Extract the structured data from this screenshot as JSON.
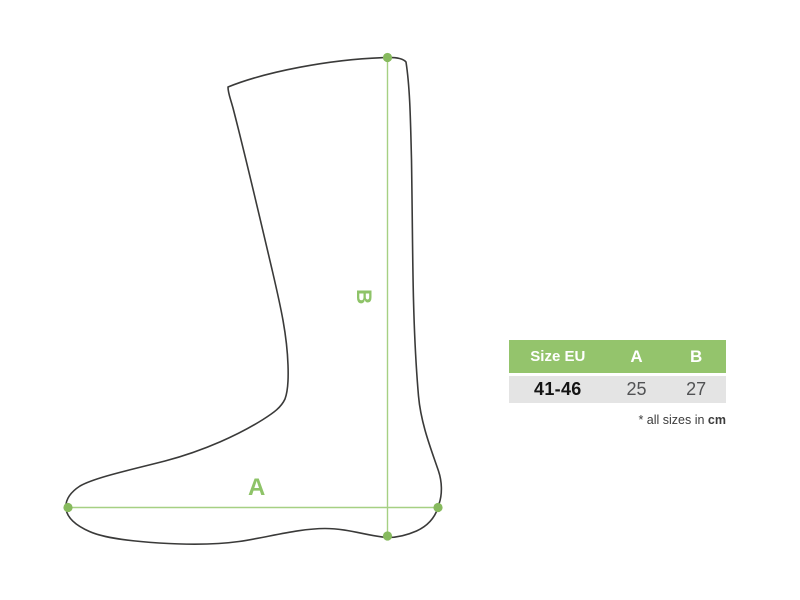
{
  "diagram": {
    "label_a": "A",
    "label_b": "B"
  },
  "table": {
    "headers": [
      "Size EU",
      "A",
      "B"
    ],
    "rows": [
      {
        "size_eu": "41-46",
        "a": "25",
        "b": "27"
      }
    ]
  },
  "note": {
    "prefix": "* all sizes in ",
    "unit": "cm"
  },
  "colors": {
    "green-header": "#94c46c",
    "green-line": "#a6d083",
    "green-dot": "#87ba5e",
    "green-label": "#8ec368",
    "row-gray": "#e4e4e4",
    "outline": "#3a3a39",
    "num-gray": "#515254",
    "text-dark": "#3c3c3c"
  }
}
